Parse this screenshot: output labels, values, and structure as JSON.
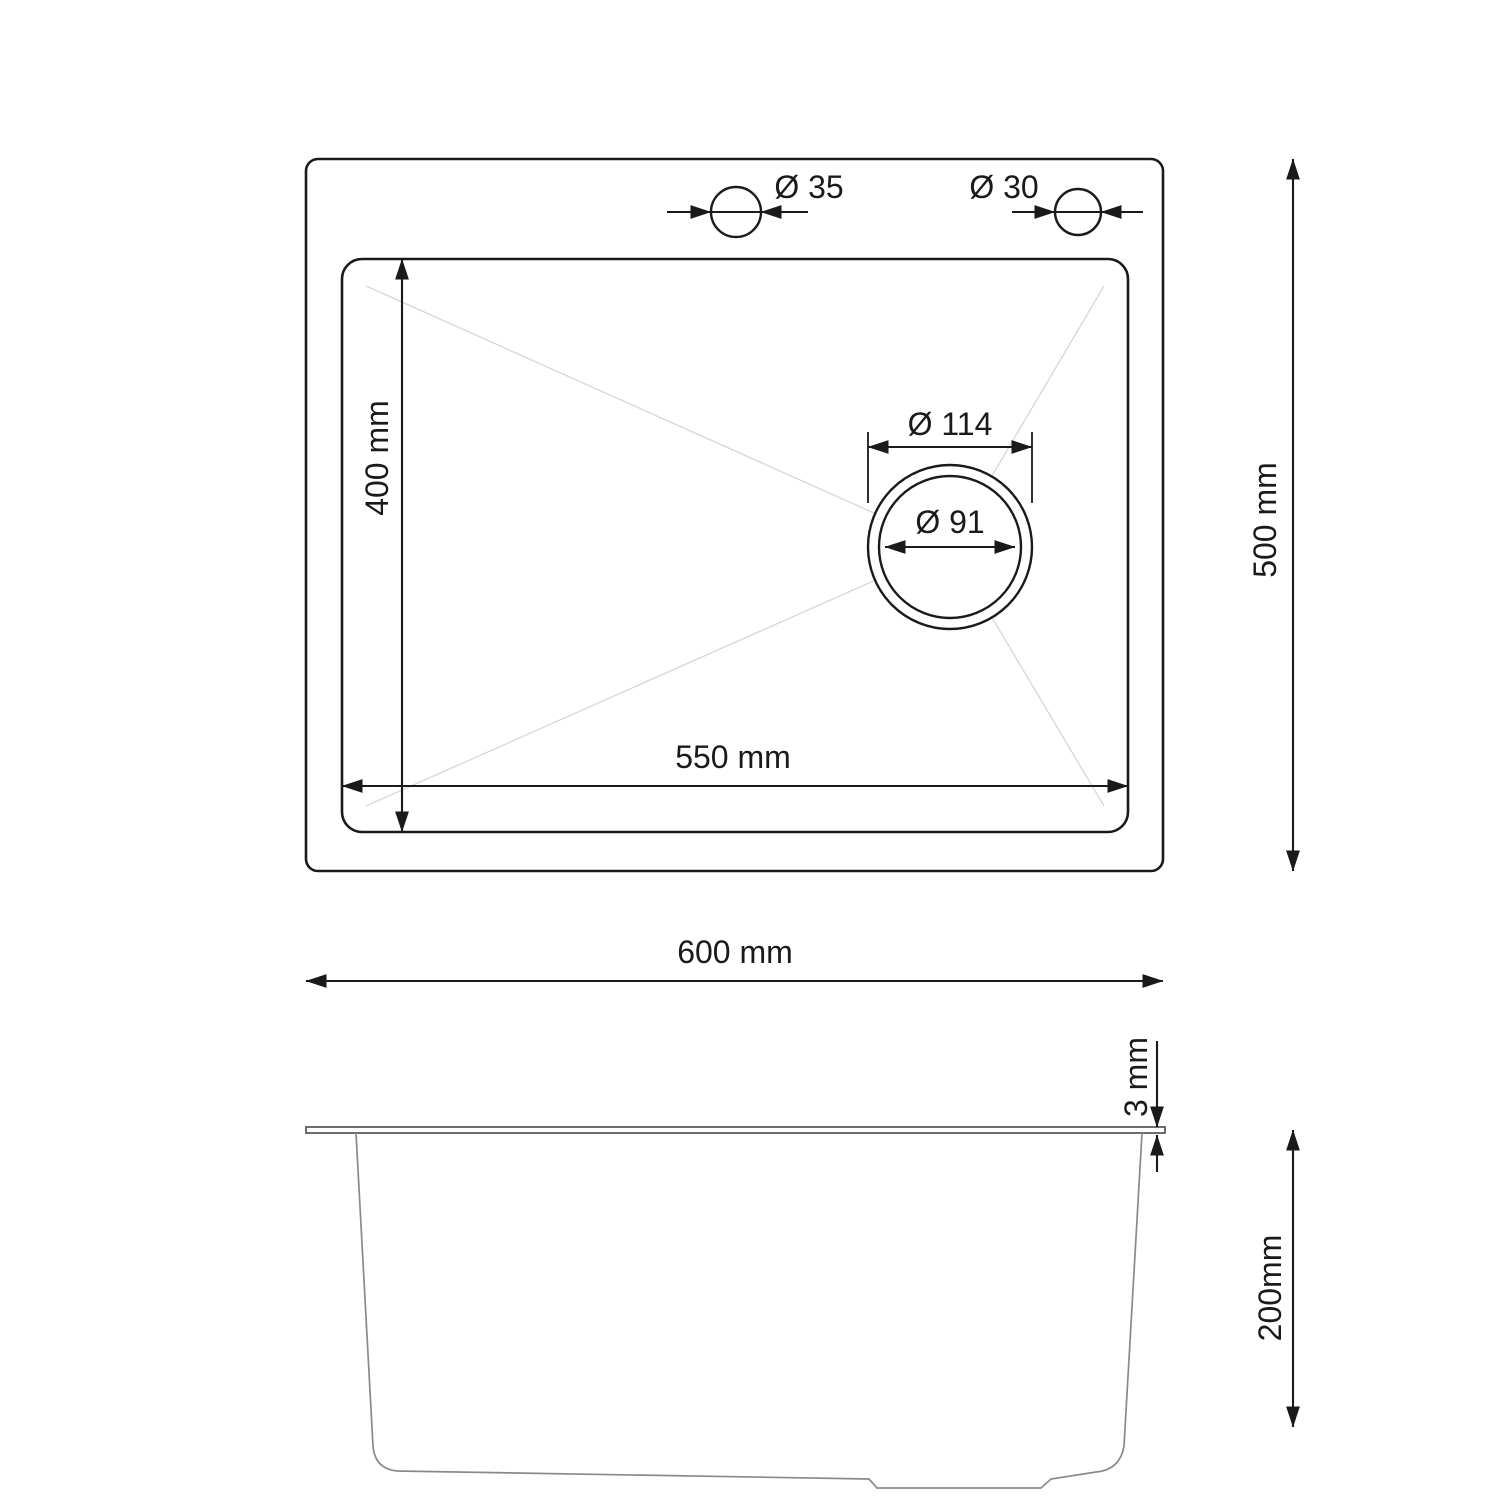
{
  "colors": {
    "background": "#ffffff",
    "primary_line": "#1a1a1a",
    "side_profile_line": "#8a8a8a",
    "rim_line": "#4a4a4a",
    "slope_guide_line": "#d9d9d9"
  },
  "top_view": {
    "overall_width_label": "600 mm",
    "overall_width_mm": 600,
    "overall_depth_label": "500 mm",
    "overall_depth_mm": 500,
    "bowl_width_label": "550 mm",
    "bowl_width_mm": 550,
    "bowl_depth_label": "400 mm",
    "bowl_depth_mm": 400,
    "faucet_hole_left_label": "Ø 35",
    "faucet_hole_left_diameter_mm": 35,
    "faucet_hole_right_label": "Ø 30",
    "faucet_hole_right_diameter_mm": 30,
    "drain_outer_label": "Ø 114",
    "drain_outer_diameter_mm": 114,
    "drain_inner_label": "Ø 91",
    "drain_inner_diameter_mm": 91
  },
  "side_view": {
    "rim_thickness_label": "3 mm",
    "rim_thickness_mm": 3,
    "bowl_height_label": "200mm",
    "bowl_height_mm": 200
  }
}
